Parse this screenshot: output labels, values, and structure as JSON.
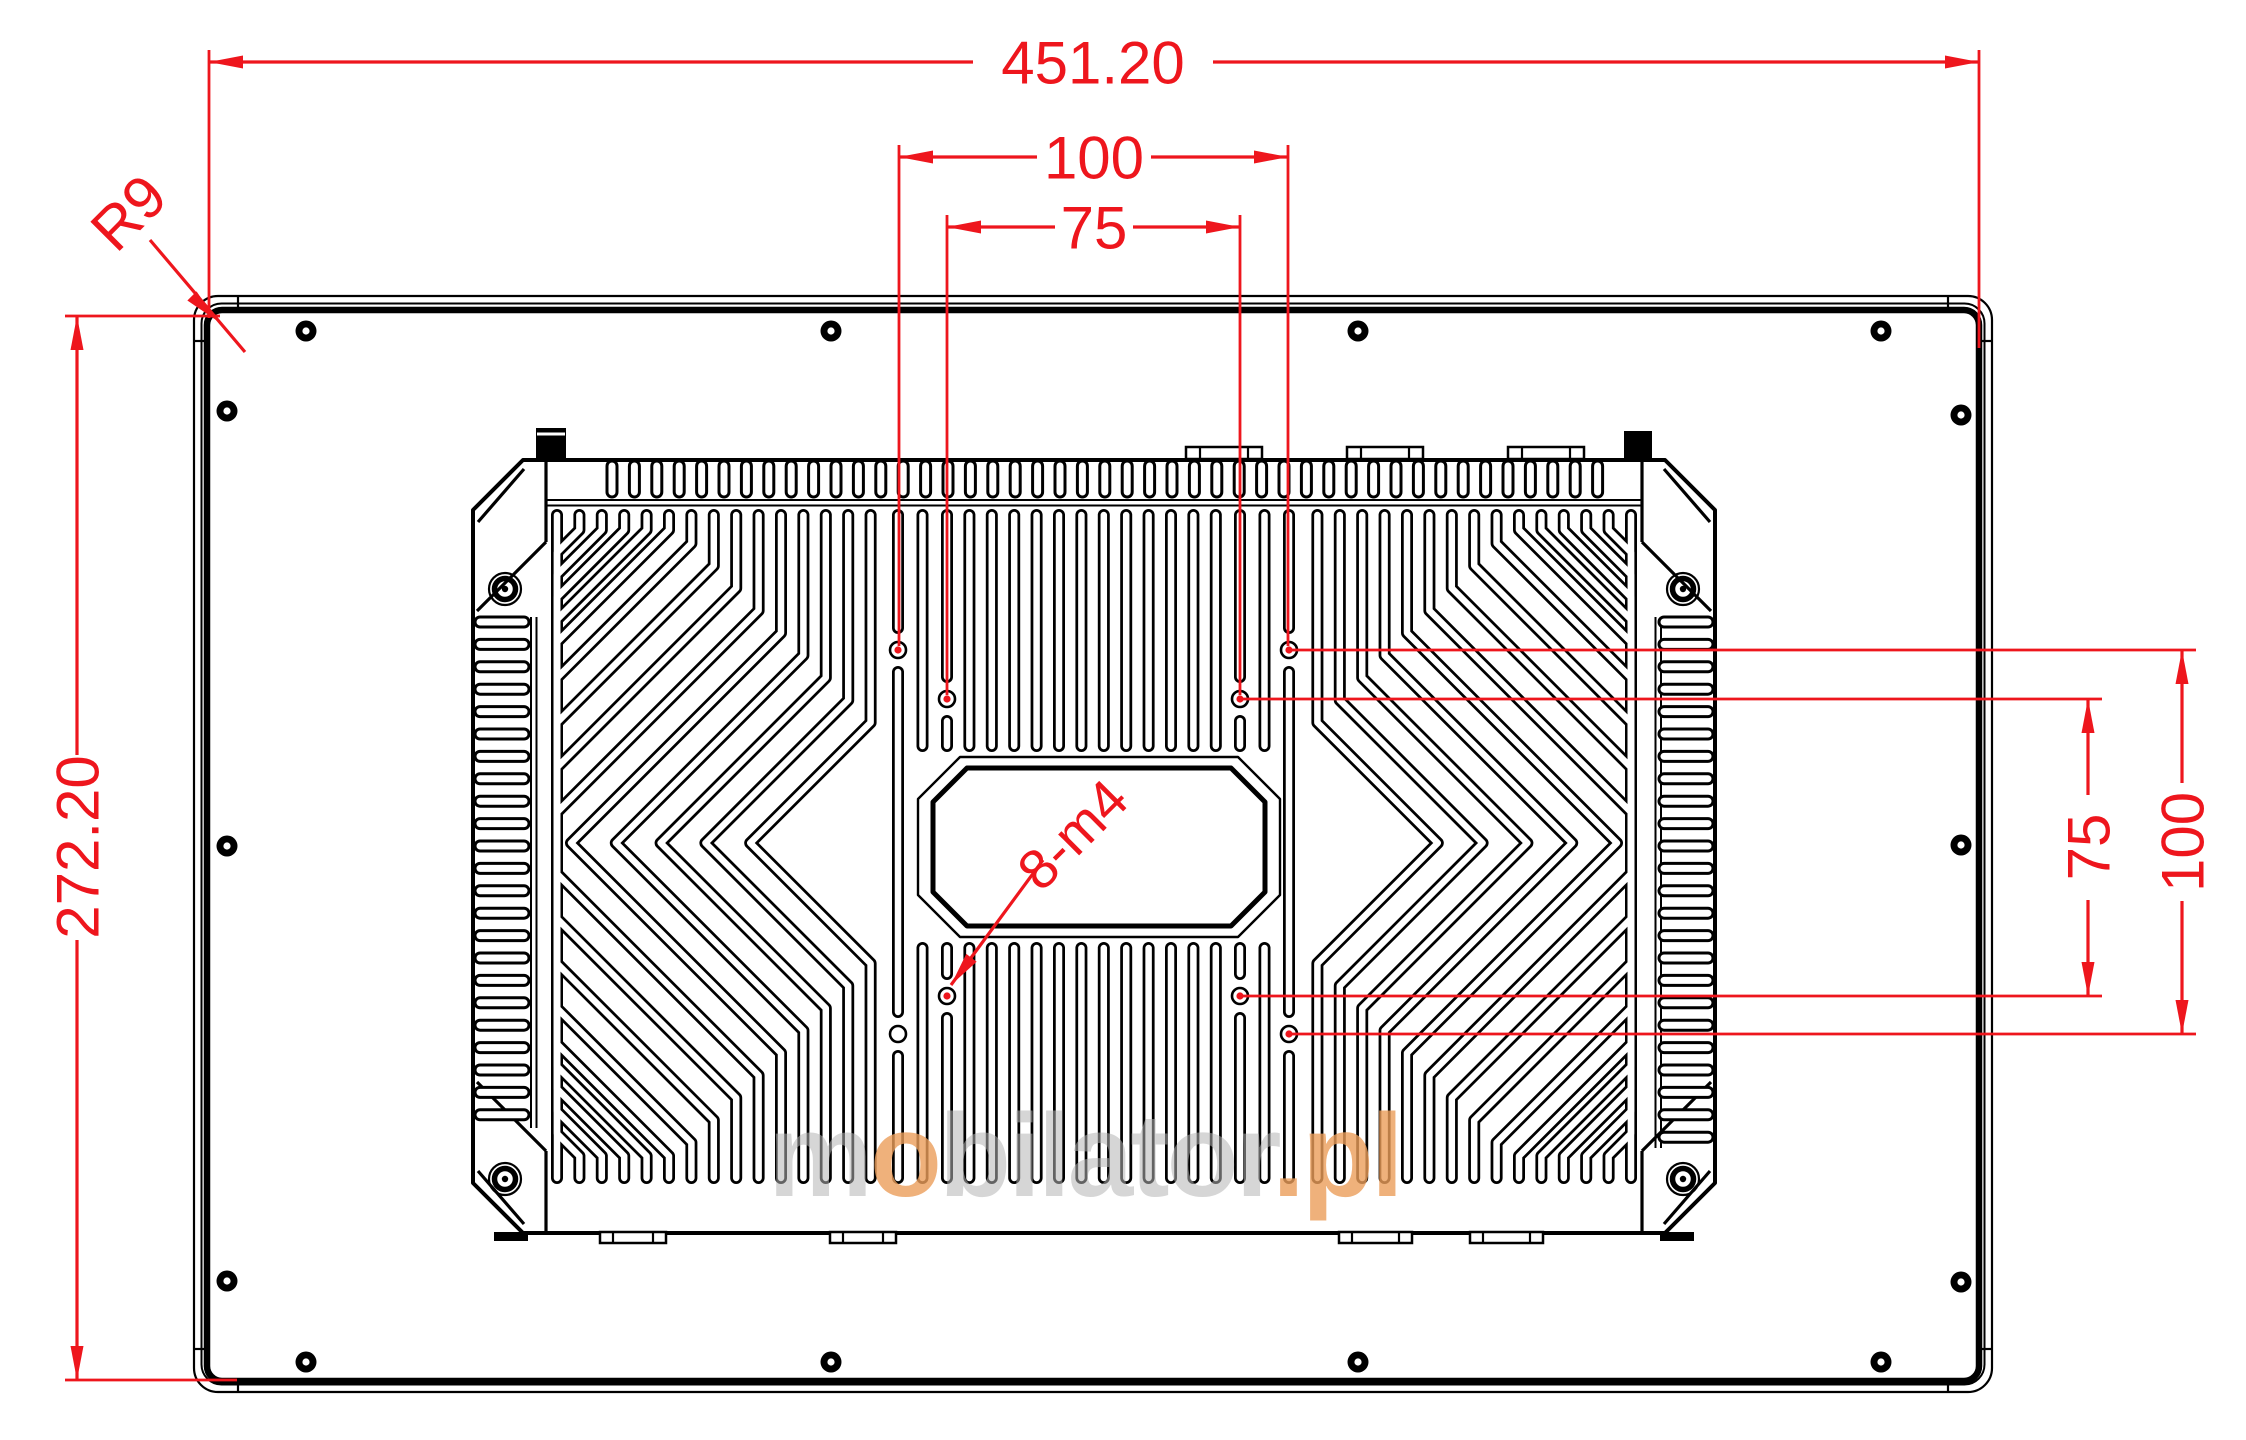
{
  "drawing": {
    "kind": "technical-dimension-drawing",
    "subject": "panel-pc-rear-view-with-vesa-mount",
    "dimensions": {
      "overall_width": "451.20",
      "overall_height": "272.20",
      "vesa_horizontal_100": "100",
      "vesa_horizontal_75": "75",
      "vesa_vertical_75": "75",
      "vesa_vertical_100": "100",
      "corner_radius": "R9",
      "mounting_holes": "8-m4"
    },
    "watermark": {
      "part_m": "m",
      "part_o": "o",
      "part_rest": "bilator",
      "part_suffix": ".pl"
    },
    "colors": {
      "dimension_red": "#ee161d",
      "line_black": "#000000",
      "background": "#ffffff",
      "watermark_gray": "#b5b5b5",
      "watermark_orange": "#eb9e5a"
    }
  }
}
